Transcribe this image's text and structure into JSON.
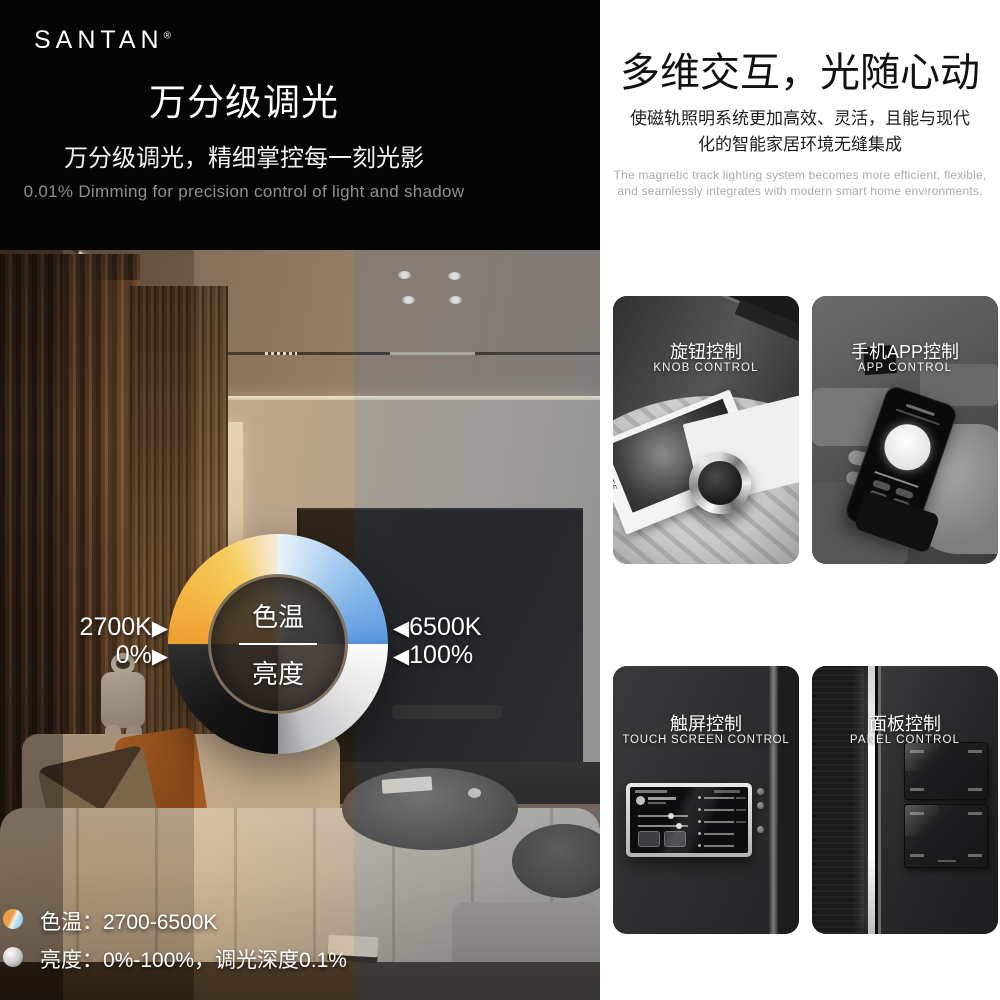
{
  "brand": {
    "name": "SANTAN",
    "registered_mark": "®"
  },
  "left": {
    "title": "万分级调光",
    "subtitle": "万分级调光，精细掌控每一刻光影",
    "subtitle_en": "0.01% Dimming for precision control of light and shadow",
    "dial": {
      "center_label_top": "色温",
      "center_label_bottom": "亮度",
      "left_top_value": "2700K",
      "left_bottom_value": "0%",
      "right_top_value": "6500K",
      "right_bottom_value": "100%",
      "arrow_toward_right": "▶",
      "arrow_toward_left": "◀"
    },
    "specs": [
      {
        "text": "色温：2700-6500K"
      },
      {
        "text": "亮度：0%-100%，调光深度0.1%"
      }
    ]
  },
  "right": {
    "title": "多维交互，光随心动",
    "desc_cn_line1": "使磁轨照明系统更加高效、灵活，且能与现代",
    "desc_cn_line2": "化的智能家居环境无缝集成",
    "desc_en_line1": "The magnetic track lighting system becomes more efficient, flexible,",
    "desc_en_line2": "and seamlessly integrates with modern smart home environments.",
    "cards": [
      {
        "title": "旋钮控制",
        "subtitle": "KNOB CONTROL",
        "photo_text": "2CHIETE"
      },
      {
        "title": "手机APP控制",
        "subtitle": "APP CONTROL"
      },
      {
        "title": "触屏控制",
        "subtitle": "TOUCH SCREEN CONTROL"
      },
      {
        "title": "面板控制",
        "subtitle": "PANEL CONTROL"
      }
    ]
  },
  "colors": {
    "warm_2700k": "#ef9f33",
    "cool_6500k": "#5e9be0",
    "dim_black": "#0d0d0d",
    "bright_white": "#fbfbfb",
    "header_bg": "#050505",
    "gray_text": "#8f8f8f"
  }
}
